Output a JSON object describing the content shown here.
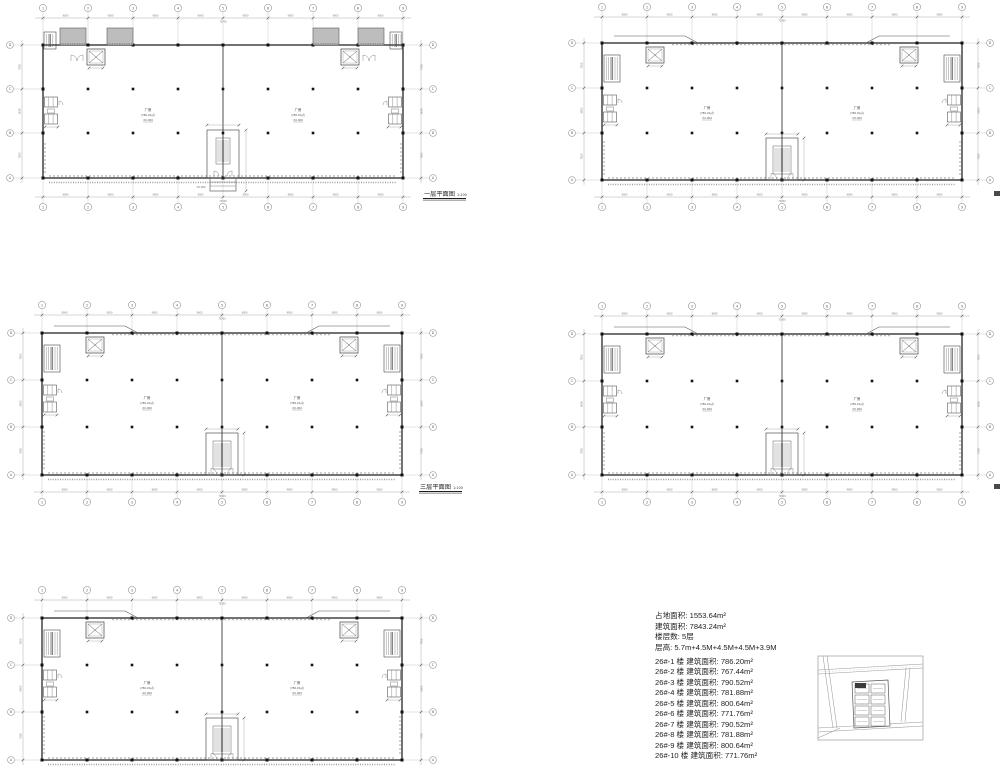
{
  "sheet": {
    "background": "#ffffff"
  },
  "colors": {
    "wall": "#2e2e2e",
    "line": "#4a4a4a",
    "thin": "#8a8a8a",
    "grid": "#b0b0b0",
    "dim": "#777777",
    "text": "#1f1f1f",
    "ramp_fill": "#bdbdbd",
    "highlight": "#3a3a3a"
  },
  "grid": {
    "cols": [
      "1",
      "2",
      "3",
      "4",
      "5",
      "6",
      "7",
      "8",
      "9"
    ],
    "rows": [
      "D",
      "C",
      "B",
      "A"
    ],
    "bay_dim": "9000",
    "total_dim": "72000",
    "row_dims": [
      "7500",
      "6000",
      "7500"
    ]
  },
  "room": {
    "name": "厂房",
    "area": "(786.20㎡)",
    "level": "±0.000"
  },
  "plans": [
    {
      "name": "floor-1",
      "title": "一层平面图",
      "scale": "1:100",
      "variant": "ground",
      "bx": 43,
      "by": 45,
      "bw": 360,
      "bh": 133,
      "top_gap": 37,
      "bottom": true,
      "bottom_gap": 29,
      "lb": 10,
      "rb": 433,
      "title_x": 424,
      "title_y": 196,
      "edge_mark": false
    },
    {
      "name": "floor-2",
      "title": "二层平面图",
      "scale": "1:100",
      "variant": "upper",
      "bx": 602,
      "by": 43,
      "bw": 360,
      "bh": 137,
      "top_gap": 36,
      "bottom": true,
      "bottom_gap": 27,
      "lb": 572,
      "rb": 990,
      "title_x": 994,
      "title_y": 197,
      "edge_mark": true
    },
    {
      "name": "floor-3",
      "title": "三层平面图",
      "scale": "1:100",
      "variant": "upper",
      "bx": 42,
      "by": 333,
      "bw": 360,
      "bh": 142,
      "top_gap": 28,
      "bottom": true,
      "bottom_gap": 27,
      "lb": 11,
      "rb": 433,
      "title_x": 420,
      "title_y": 489,
      "edge_mark": false
    },
    {
      "name": "floor-4",
      "title": "四层平面图",
      "scale": "1:100",
      "variant": "upper",
      "bx": 602,
      "by": 334,
      "bw": 360,
      "bh": 141,
      "top_gap": 28,
      "bottom": true,
      "bottom_gap": 27,
      "lb": 572,
      "rb": 990,
      "title_x": 994,
      "title_y": 490,
      "edge_mark": true
    },
    {
      "name": "floor-5",
      "title": "",
      "scale": "",
      "variant": "upper",
      "bx": 42,
      "by": 618,
      "bw": 360,
      "bh": 142,
      "top_gap": 28,
      "bottom": false,
      "bottom_gap": 0,
      "lb": 11,
      "rb": 433,
      "title_x": 0,
      "title_y": 0,
      "edge_mark": false
    }
  ],
  "stats": {
    "lines": [
      "占地面积: 1553.64m²",
      "建筑面积: 7843.24m²",
      "楼层数: 5层",
      "层高: 5.7m+4.5M+4.5M+4.5M+3.9M"
    ],
    "units": [
      "26#-1 楼 建筑面积: 786.20m²",
      "26#-2 楼 建筑面积: 767.44m²",
      "26#-3 楼 建筑面积: 790.52m²",
      "26#-4 楼 建筑面积: 781.88m²",
      "26#-5 楼 建筑面积: 800.64m²",
      "26#-6 楼 建筑面积: 771.76m²",
      "26#-7 楼 建筑面积: 790.52m²",
      "26#-8 楼 建筑面积: 781.88m²",
      "26#-9 楼 建筑面积: 800.64m²",
      "26#-10 楼 建筑面积: 771.76m²"
    ]
  },
  "key_map": {
    "x": 818,
    "y": 656,
    "w": 105,
    "h": 84,
    "highlight_block": "building-26"
  }
}
